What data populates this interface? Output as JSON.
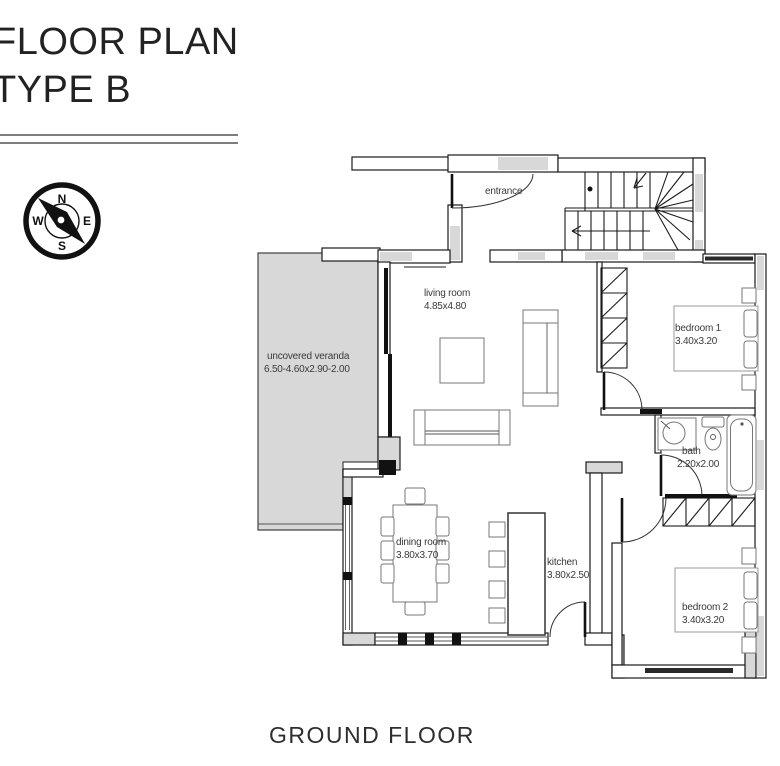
{
  "title": {
    "line1": "FLOOR PLAN",
    "line2": "TYPE B"
  },
  "caption": "GROUND FLOOR",
  "compass": {
    "n": "N",
    "e": "E",
    "s": "S",
    "w": "W"
  },
  "rooms": [
    {
      "id": "entrance",
      "name": "entrance",
      "dims": ""
    },
    {
      "id": "living-room",
      "name": "living room",
      "dims": "4.85x4.80"
    },
    {
      "id": "uncovered-veranda",
      "name": "uncovered veranda",
      "dims": "6.50-4.60x2.90-2.00"
    },
    {
      "id": "dining-room",
      "name": "dining room",
      "dims": "3.80x3.70"
    },
    {
      "id": "kitchen",
      "name": "kitchen",
      "dims": "3.80x2.50"
    },
    {
      "id": "bedroom-1",
      "name": "bedroom 1",
      "dims": "3.40x3.20"
    },
    {
      "id": "bath",
      "name": "bath",
      "dims": "2.20x2.00"
    },
    {
      "id": "bedroom-2",
      "name": "bedroom 2",
      "dims": "3.40x3.20"
    }
  ],
  "colors": {
    "wall_fill": "#d8d8d8",
    "line": "#1a1a1a",
    "text": "#3a3a3a",
    "rule": "#7d7d7d"
  }
}
